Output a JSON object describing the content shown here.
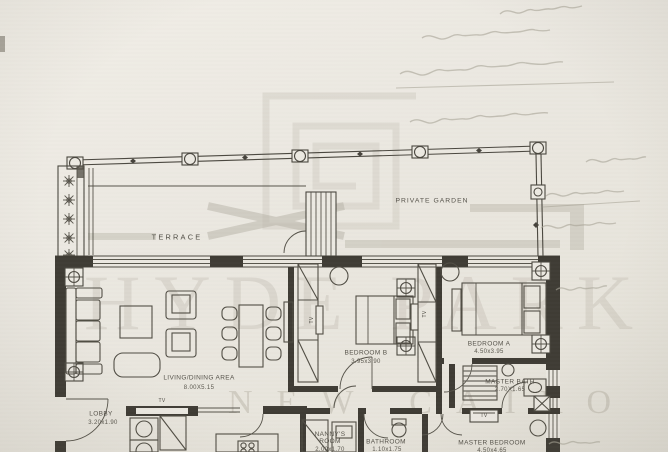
{
  "watermark": {
    "brand_top": "HYDE PARK",
    "brand_bottom": "NEW CAIRO"
  },
  "outdoor": {
    "terrace_label": "TERRACE",
    "private_garden_label": "PRIVATE GARDEN"
  },
  "rooms": {
    "living": {
      "label": "LIVING/DINING AREA",
      "dims": "8.00X5.15"
    },
    "lobby": {
      "label": "LOBBY",
      "dims": "3.20x1.90"
    },
    "bedroom_b": {
      "label": "BEDROOM B",
      "dims": "3.95x3.90"
    },
    "bedroom_a": {
      "label": "BEDROOM A",
      "dims": "4.50x3.95"
    },
    "master_bath": {
      "label": "MASTER BATH",
      "dims": "2.70X1.65"
    },
    "nannys_room": {
      "label": "NANNY'S ROOM",
      "dims": "2.00x1.70"
    },
    "bathroom": {
      "label": "BATHROOM",
      "dims": "1.10x1.75"
    },
    "master_bedroom": {
      "label": "MASTER BEDROOM",
      "dims": "4.50x4.65"
    }
  },
  "fixtures": {
    "tv_label": "TV"
  },
  "colors": {
    "paper": "#ebe8e1",
    "ink": "#4a473f",
    "wall": "#3e3b34",
    "watermark_gray": "#b9b5a9"
  }
}
